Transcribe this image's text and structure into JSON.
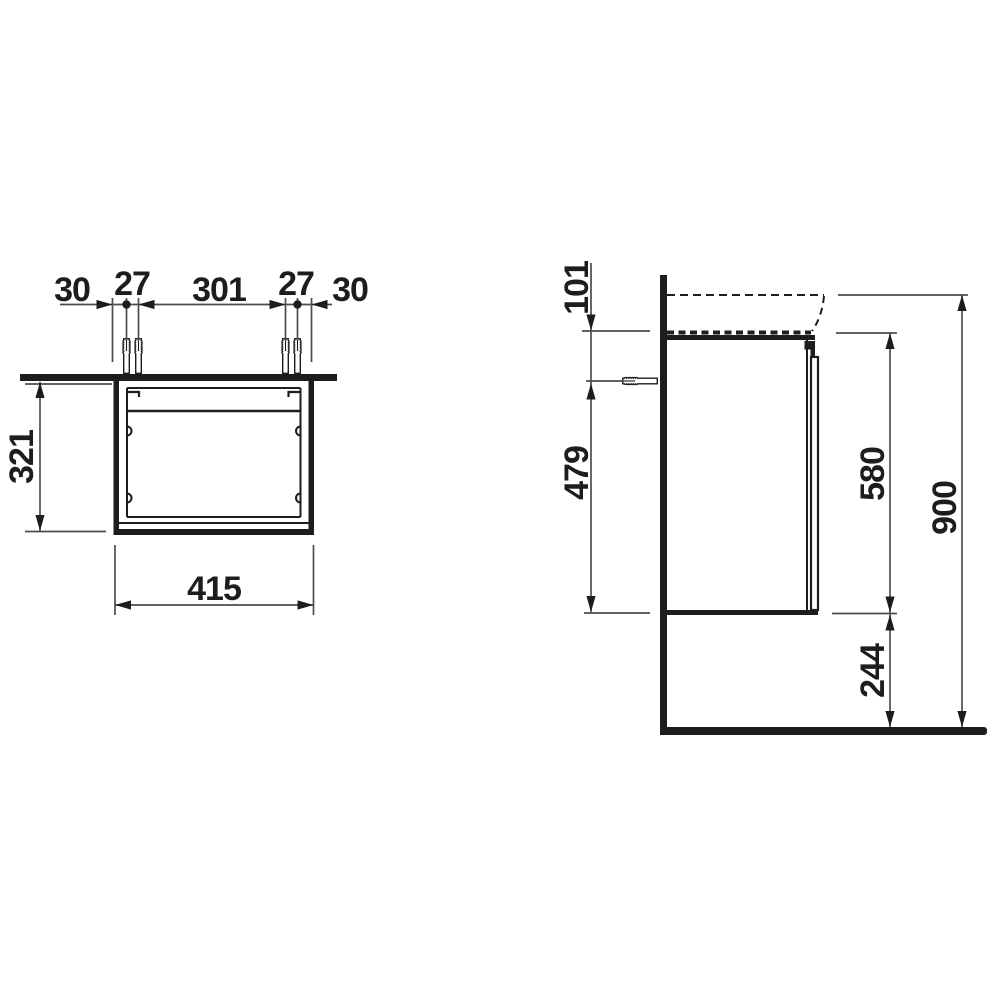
{
  "drawing": {
    "front_view": {
      "top_dims": [
        "30",
        "27",
        "301",
        "27",
        "30"
      ],
      "height": "321",
      "width": "415"
    },
    "side_view": {
      "basin_to_cabinet_top": "101",
      "anchor_to_cabinet_bottom": "479",
      "cabinet_height": "580",
      "total_height": "900",
      "floor_to_cabinet_bottom": "244"
    },
    "colors": {
      "object_line": "#1d1d1b",
      "dimension_line": "#4d4d4d",
      "background": "#ffffff"
    }
  }
}
